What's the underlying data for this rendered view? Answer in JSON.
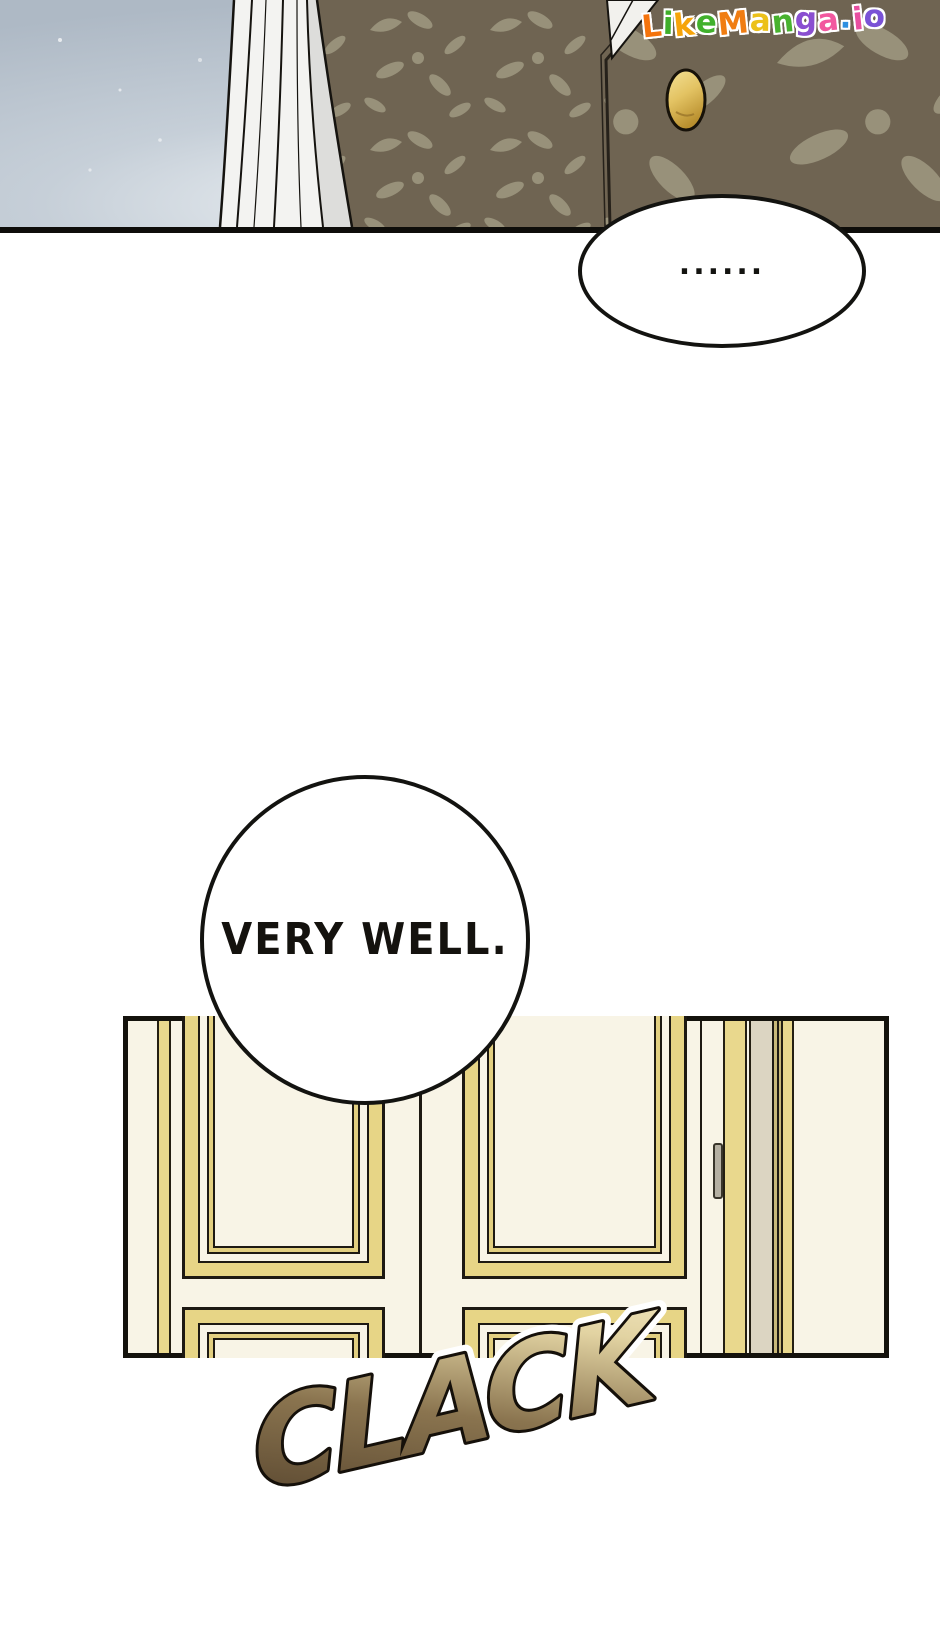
{
  "watermark": {
    "text": "LikeManga.io",
    "letters": [
      {
        "ch": "L",
        "color": "#f4730c"
      },
      {
        "ch": "i",
        "color": "#3fae2a"
      },
      {
        "ch": "k",
        "color": "#f6a40a"
      },
      {
        "ch": "e",
        "color": "#41b02c"
      },
      {
        "ch": "M",
        "color": "#f07d12"
      },
      {
        "ch": "a",
        "color": "#ecc11a"
      },
      {
        "ch": "n",
        "color": "#48b22e"
      },
      {
        "ch": "g",
        "color": "#8a4fd0"
      },
      {
        "ch": "a",
        "color": "#f2589f"
      },
      {
        "ch": ".",
        "color": "#2e8fe0"
      },
      {
        "ch": "i",
        "color": "#e84fa0"
      },
      {
        "ch": "o",
        "color": "#7a52d6"
      }
    ]
  },
  "speech_bubbles": {
    "silence": {
      "text": "......"
    },
    "very_well": {
      "text": "VERY WELL."
    }
  },
  "sound_effect": {
    "text": "CLACK",
    "color_dark": "#54422c",
    "color_light": "#f2e7bf"
  },
  "scene": {
    "colors": {
      "window_light": "#c6cfd8",
      "veil_white": "#f3f3f1",
      "vest_base": "#6f6452",
      "vest_motif": "#9c967e",
      "button_gold": "#e3c363",
      "door_cream": "#f8f4e6",
      "door_gold": "#e7d586",
      "door_beige": "#dcd5c2",
      "handle_gray": "#b5b0a2"
    }
  }
}
